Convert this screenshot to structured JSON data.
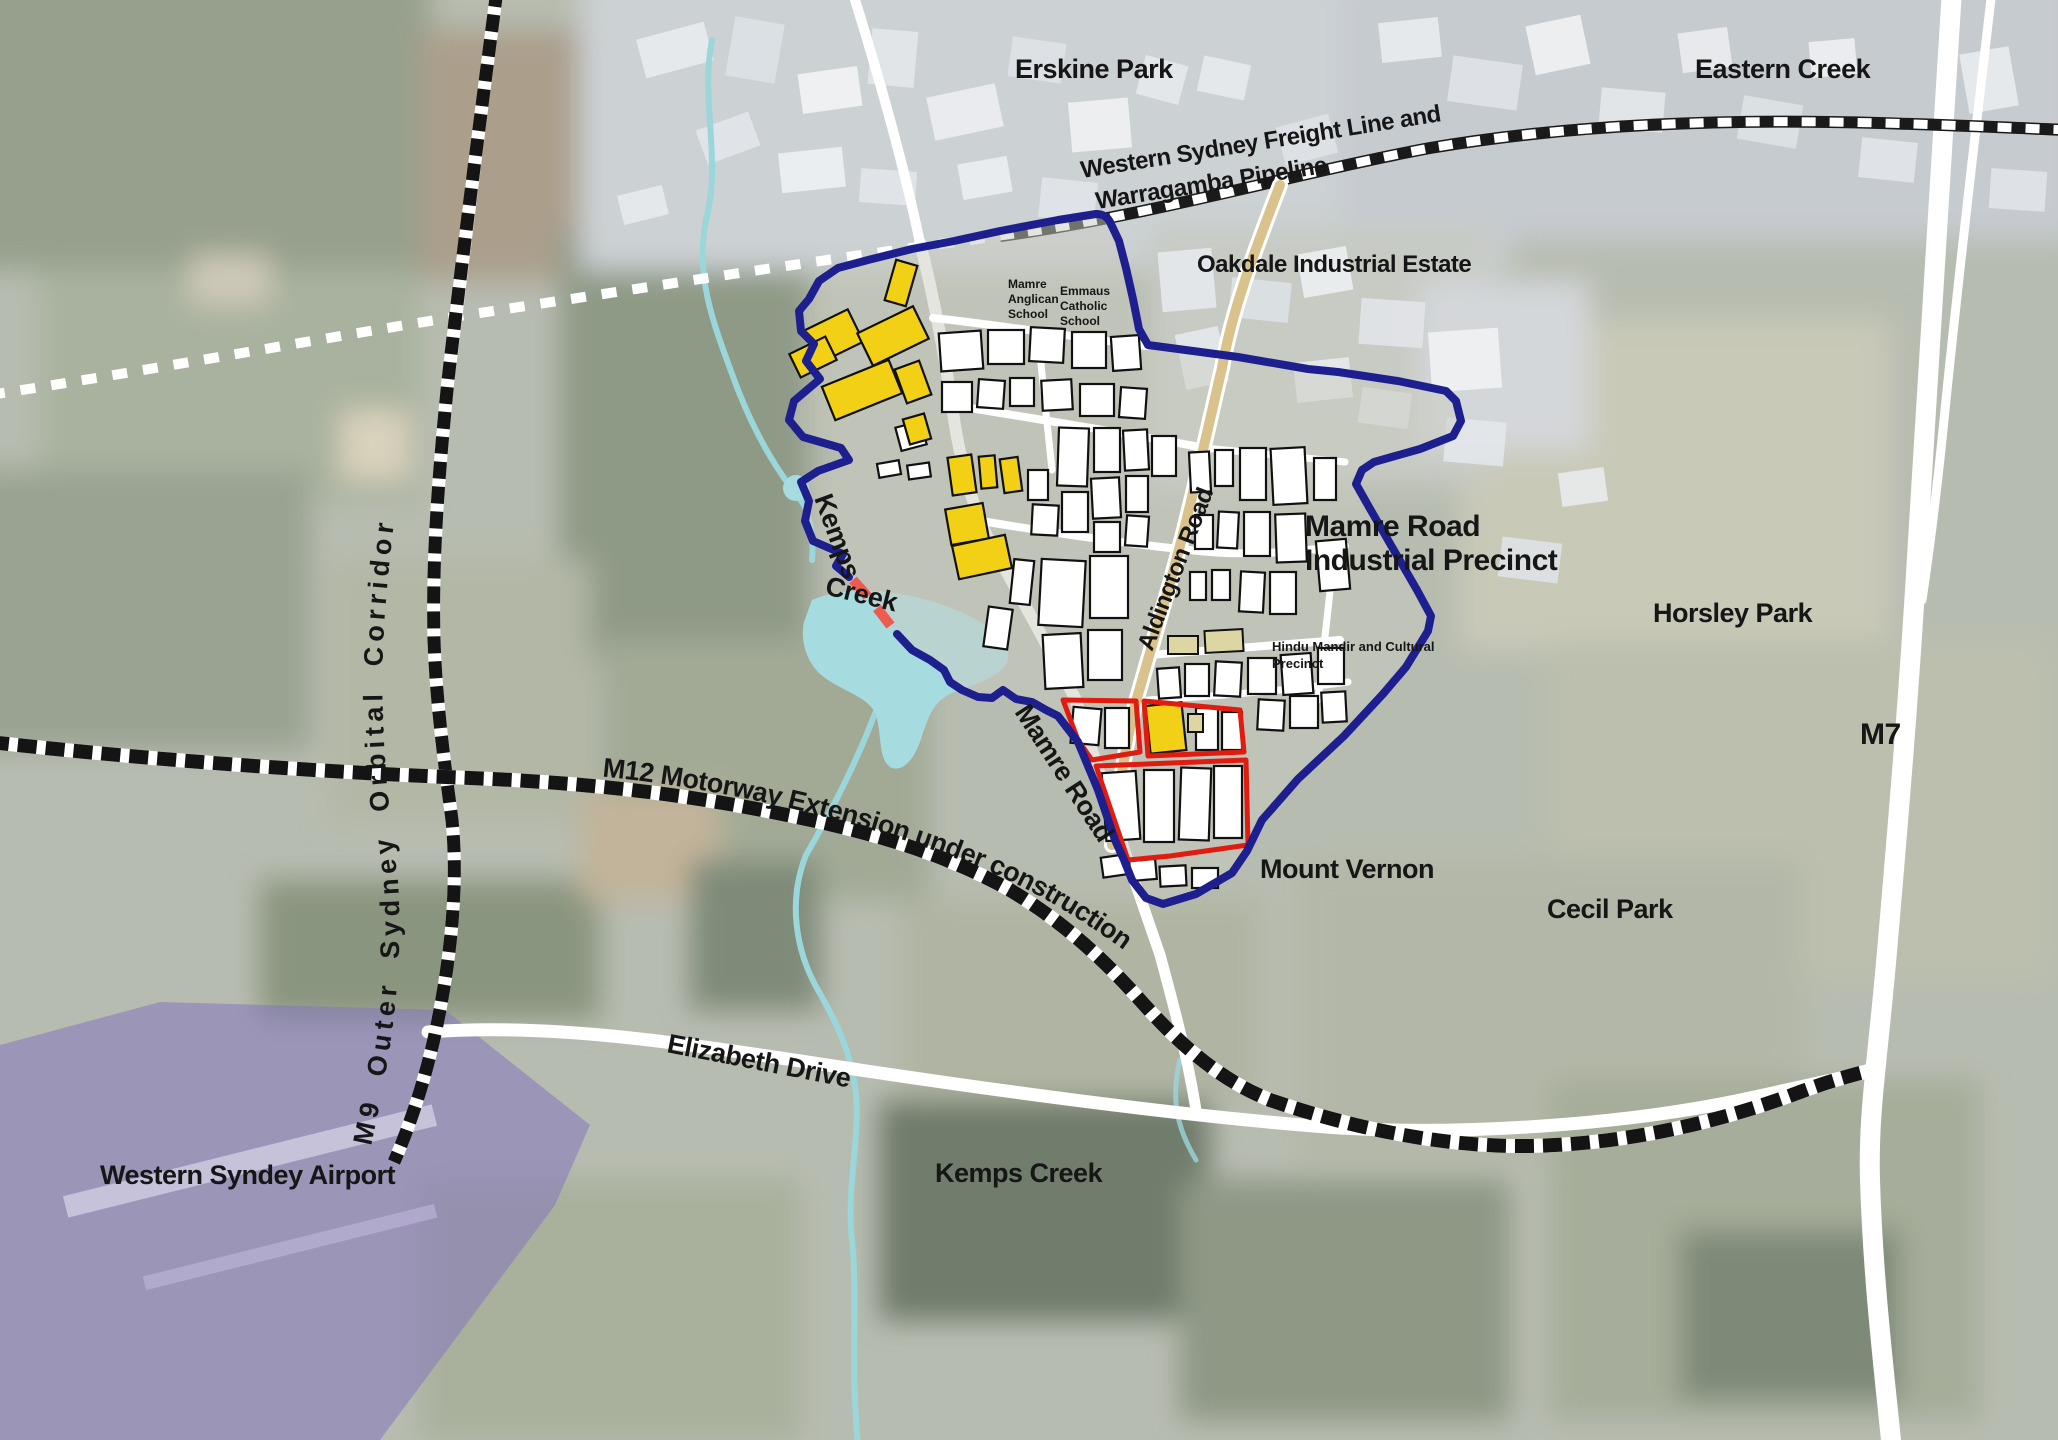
{
  "labels": {
    "erskine_park": "Erskine Park",
    "eastern_creek": "Eastern Creek",
    "oakdale_industrial_estate": "Oakdale Industrial Estate",
    "freight_line": {
      "line1": "Western Sydney Freight Line and",
      "line2": "Warragamba Pipeline"
    },
    "mamre_anglican_school": {
      "line1": "Mamre",
      "line2": "Anglican",
      "line3": "School"
    },
    "emmaus_catholic_school": {
      "line1": "Emmaus",
      "line2": "Catholic",
      "line3": "School"
    },
    "precinct": {
      "line1": "Mamre Road",
      "line2": "Industrial Precinct"
    },
    "horsley_park": "Horsley Park",
    "m7": "M7",
    "kemps": "Kemps",
    "creek": "Creek",
    "aldington_road": "Aldington Road",
    "mamre_road": "Mamre Road",
    "hindu_mandir": {
      "line1": "Hindu Mandir and Cultural",
      "line2": "Precinct"
    },
    "mount_vernon": "Mount Vernon",
    "cecil_park": "Cecil Park",
    "m12": "M12 Motorway Extension under construction",
    "m9": "M9 Outer Sydney Orbital Corridor",
    "elizabeth_drive": "Elizabeth Drive",
    "western_sydney_airport": "Western Syndey Airport",
    "kemps_creek_suburb": "Kemps Creek"
  },
  "colors": {
    "precinct_boundary_blue": "#1d1f8f",
    "investigation_area_red": "#e01b10",
    "highlight_lot_yellow": "#f2d015",
    "lot_white": "#ffffff",
    "community_lot_khaki": "#ddd6a2",
    "water_cyan": "#a6dbe0",
    "airport_overlay_purple": "#8273c0",
    "road_white": "#ffffff",
    "aldington_road_tan": "#d9c28c",
    "creek_gap_dash_red": "#ee5a4f",
    "label_black": "#161616"
  }
}
